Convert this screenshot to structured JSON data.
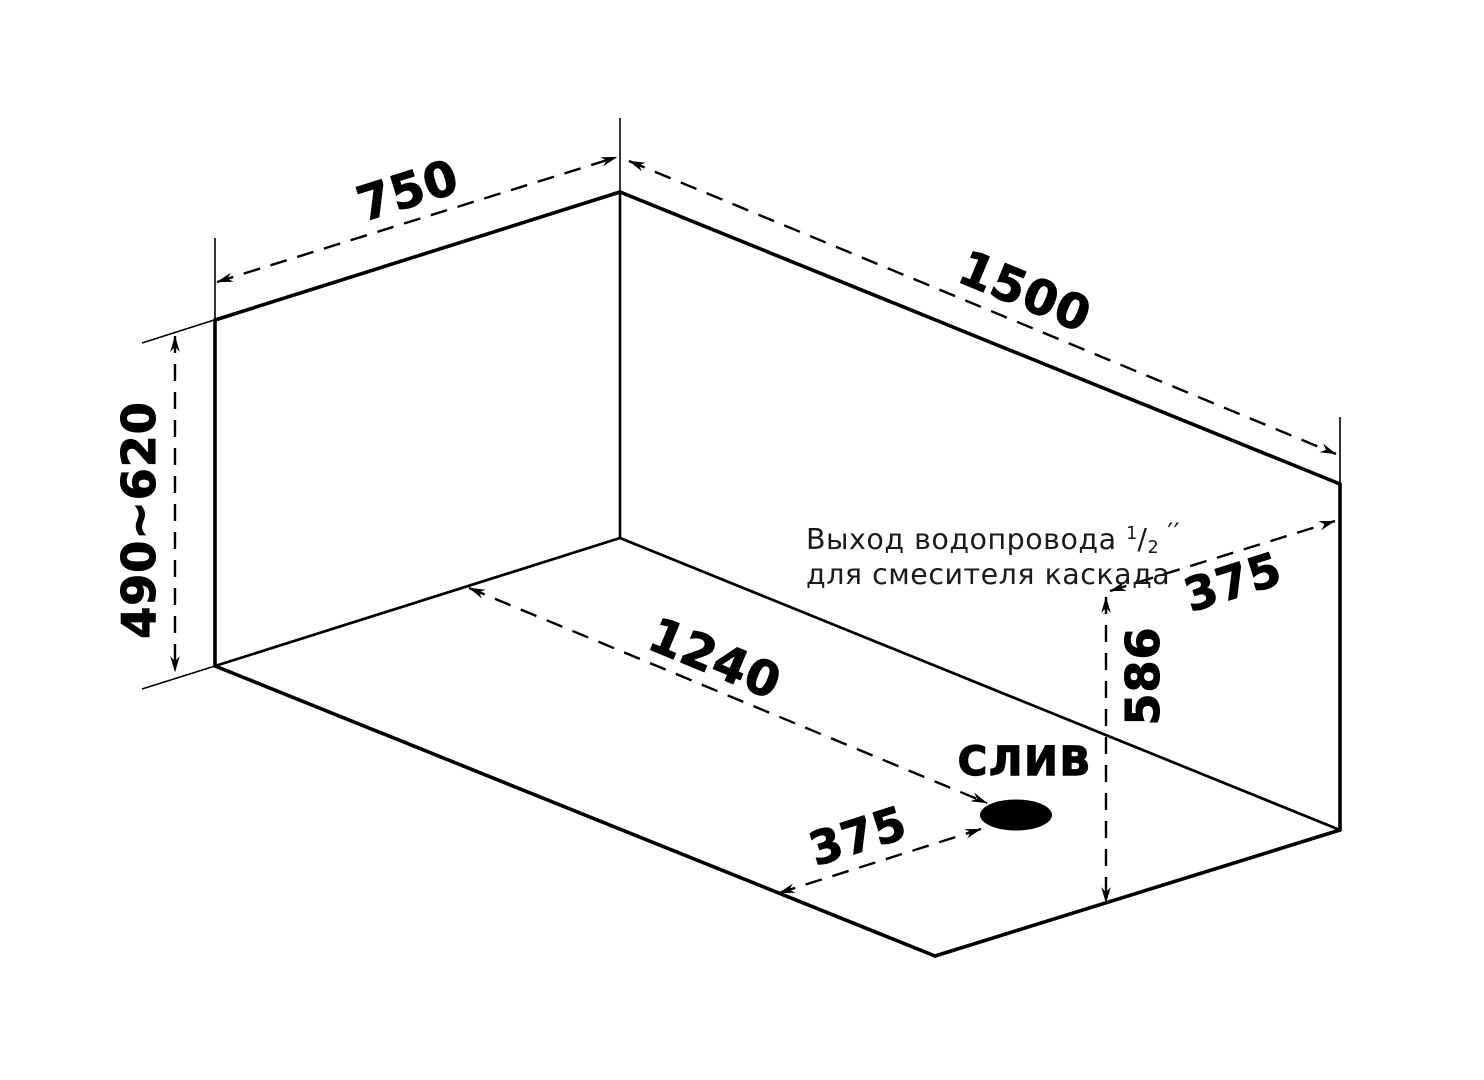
{
  "diagram": {
    "drain": {
      "label": "СЛИВ"
    },
    "note": {
      "line1_prefix": "Выход водопровода ",
      "fraction_numerator": "1",
      "fraction_slash": "/",
      "fraction_denominator": "2",
      "inch_marks": " ′′",
      "line2": "для смесителя каскада"
    },
    "dimensions": {
      "top_width": {
        "value": "750"
      },
      "top_length": {
        "value": "1500"
      },
      "height_range": {
        "value": "490~620"
      },
      "bottom_length_to_drain": {
        "value": "1240"
      },
      "bottom_width_to_drain": {
        "value": "375"
      },
      "side_height": {
        "value": "586"
      },
      "side_width_to_drain": {
        "value": "375"
      }
    },
    "colors": {
      "line": "#000000",
      "background": "#ffffff"
    }
  }
}
